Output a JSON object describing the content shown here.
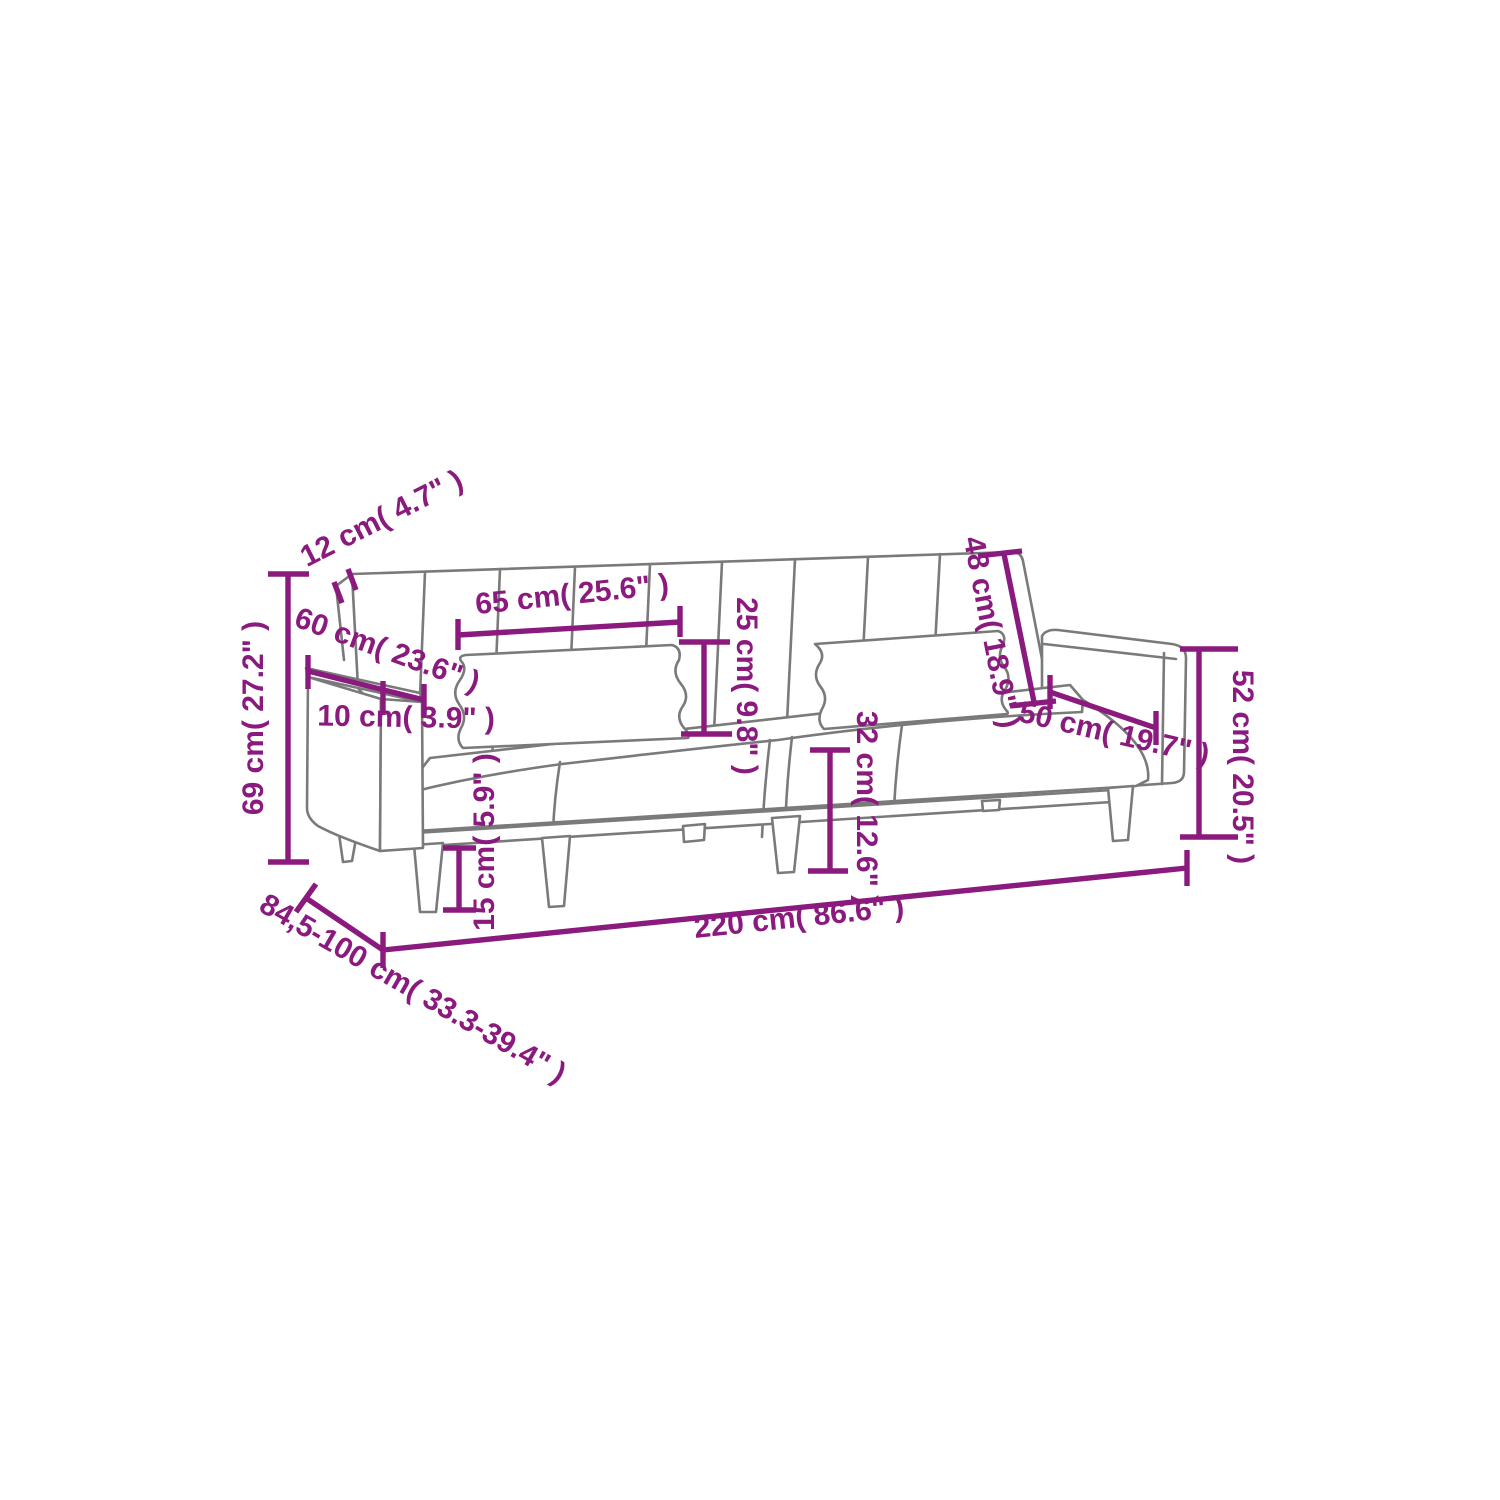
{
  "diagram": {
    "subject": "sofa-bed line drawing with measurement annotations",
    "colors": {
      "dimension_annotation": "#8b1a7e",
      "product_outline": "#7a7a7a",
      "background": "#ffffff"
    },
    "dimensions": {
      "backrest_thickness": {
        "label": "12 cm( 4.7\" )"
      },
      "pillow_width": {
        "label": "65 cm( 25.6\" )"
      },
      "pillow_height": {
        "label": "25 cm( 9.8\" )"
      },
      "backrest_height": {
        "label": "48 cm( 18.9\" )"
      },
      "armrest_depth": {
        "label": "60 cm( 23.6\" )"
      },
      "armrest_width": {
        "label": "10 cm( 3.9\" )"
      },
      "total_height": {
        "label": "69 cm( 27.2\" )"
      },
      "arm_side_height": {
        "label": "52 cm( 20.5\" )"
      },
      "seat_depth": {
        "label": "50 cm( 19.7\" )"
      },
      "seat_height": {
        "label": "32 cm( 12.6\" )"
      },
      "leg_height": {
        "label": "15 cm( 5.9\" )"
      },
      "total_width": {
        "label": "220 cm( 86.6\" )"
      },
      "total_depth_range": {
        "label": "84,5-100 cm( 33.3-39.4\" )"
      }
    }
  }
}
